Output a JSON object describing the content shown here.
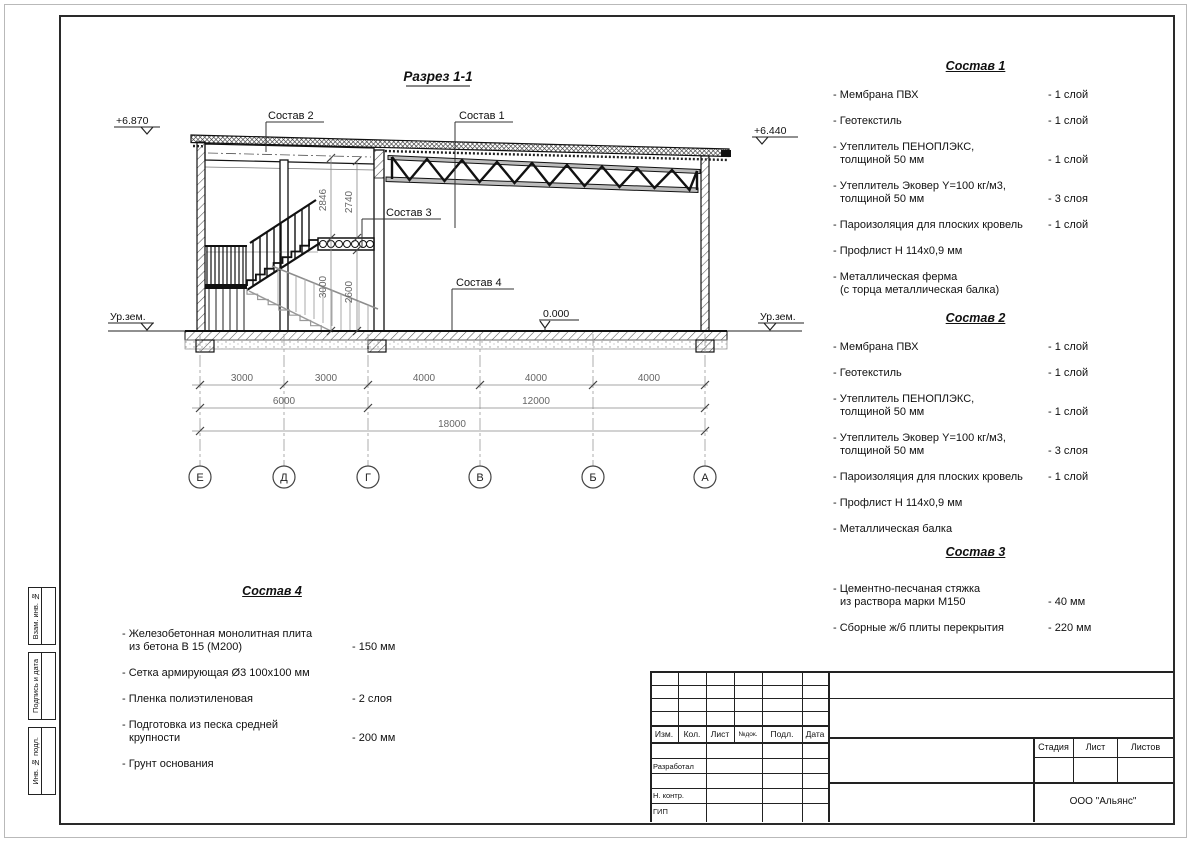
{
  "drawing": {
    "title": "Разрез 1-1",
    "levels": {
      "top_left": "+6.870",
      "top_right": "+6.440",
      "zero": "0.000",
      "ground": "Ур.зем."
    },
    "callouts": {
      "c1": "Состав 1",
      "c2": "Состав 2",
      "c3": "Состав 3",
      "c4": "Состав 4"
    },
    "vdims": [
      "2846",
      "2740",
      "3000",
      "2600"
    ],
    "hdims1": [
      "3000",
      "3000",
      "4000",
      "4000",
      "4000"
    ],
    "hdims2": [
      "6000",
      "12000"
    ],
    "hdims3": [
      "18000"
    ],
    "axes": [
      "Е",
      "Д",
      "Г",
      "В",
      "Б",
      "А"
    ]
  },
  "lists": [
    {
      "title": "Состав 1",
      "items": [
        {
          "name": "- Мембрана ПВХ",
          "name2": "",
          "qty": "- 1 слой"
        },
        {
          "name": "- Геотекстиль",
          "name2": "",
          "qty": "- 1 слой"
        },
        {
          "name": "- Утеплитель ПЕНОПЛЭКС,",
          "name2": "толщиной 50 мм",
          "qty": "- 1 слой"
        },
        {
          "name": "- Утеплитель Эковер Y=100 кг/м3,",
          "name2": "толщиной 50 мм",
          "qty": "- 3 слоя"
        },
        {
          "name": "- Пароизоляция для плоских кровель",
          "name2": "",
          "qty": "- 1 слой"
        },
        {
          "name": "- Профлист Н 114х0,9 мм",
          "name2": "",
          "qty": ""
        },
        {
          "name": "- Металлическая ферма",
          "name2": "(с торца металлическая балка)",
          "qty": ""
        }
      ]
    },
    {
      "title": "Состав 2",
      "items": [
        {
          "name": "- Мембрана ПВХ",
          "name2": "",
          "qty": "- 1 слой"
        },
        {
          "name": "- Геотекстиль",
          "name2": "",
          "qty": "- 1 слой"
        },
        {
          "name": "- Утеплитель ПЕНОПЛЭКС,",
          "name2": "толщиной 50 мм",
          "qty": "- 1 слой"
        },
        {
          "name": "- Утеплитель Эковер Y=100 кг/м3,",
          "name2": "толщиной 50 мм",
          "qty": "- 3 слоя"
        },
        {
          "name": "- Пароизоляция для плоских кровель",
          "name2": "",
          "qty": "- 1 слой"
        },
        {
          "name": "- Профлист Н 114х0,9 мм",
          "name2": "",
          "qty": ""
        },
        {
          "name": "- Металлическая балка",
          "name2": "",
          "qty": ""
        }
      ]
    },
    {
      "title": "Состав 3",
      "items": [
        {
          "name": "- Цементно-песчаная стяжка",
          "name2": "из раствора марки М150",
          "qty": "- 40 мм"
        },
        {
          "name": "- Сборные ж/б плиты перекрытия",
          "name2": "",
          "qty": "- 220 мм"
        }
      ]
    },
    {
      "title": "Состав 4",
      "items": [
        {
          "name": "- Железобетонная  монолитная плита",
          "name2": "из бетона В 15 (М200)",
          "qty": "- 150 мм"
        },
        {
          "name": "- Сетка армирующая Ø3 100х100 мм",
          "name2": "",
          "qty": ""
        },
        {
          "name": "- Пленка полиэтиленовая",
          "name2": "",
          "qty": "- 2 слоя"
        },
        {
          "name": "- Подготовка из песка средней",
          "name2": "крупности",
          "qty": "- 200 мм"
        },
        {
          "name": "- Грунт основания",
          "name2": "",
          "qty": ""
        }
      ]
    }
  ],
  "titleblock": {
    "cols": [
      "Изм.",
      "Кол.",
      "Лист",
      "№док.",
      "Подл.",
      "Дата"
    ],
    "roles": [
      "Разработал",
      "Н. контр.",
      "ГИП"
    ],
    "stage": [
      "Стадия",
      "Лист",
      "Листов"
    ],
    "company": "ООО \"Альянс\""
  },
  "side": [
    "Взам. инв. №",
    "Подпись и дата",
    "Инв. № подл."
  ]
}
